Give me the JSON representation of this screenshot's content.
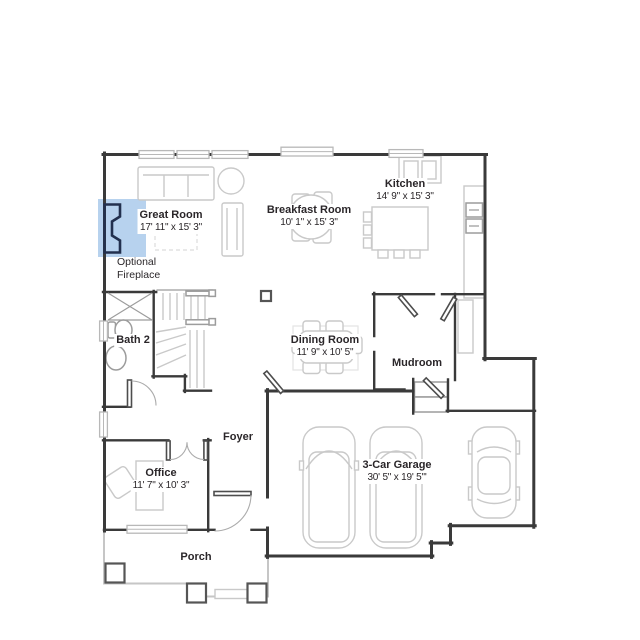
{
  "colors": {
    "wall": "#3a3a3a",
    "line_light": "#c9c9c9",
    "line_mid": "#9c9c9c",
    "text": "#2a2629",
    "fireplace_highlight": "#b7d2ee",
    "fireplace_symbol": "#22304e",
    "background": "#ffffff"
  },
  "rooms": {
    "great_room": {
      "name": "Great Room",
      "dims": "17' 11\" x 15' 3\""
    },
    "breakfast_room": {
      "name": "Breakfast Room",
      "dims": "10' 1\" x 15' 3\""
    },
    "kitchen": {
      "name": "Kitchen",
      "dims": "14' 9\" x 15' 3\""
    },
    "bath_2": {
      "name": "Bath 2"
    },
    "dining_room": {
      "name": "Dining Room",
      "dims": "11' 9\" x 10' 5\""
    },
    "mudroom": {
      "name": "Mudroom"
    },
    "foyer": {
      "name": "Foyer"
    },
    "office": {
      "name": "Office",
      "dims": "11' 7\" x 10' 3\""
    },
    "porch": {
      "name": "Porch"
    },
    "garage": {
      "name": "3-Car Garage",
      "dims": "30' 5\" x 19' 5\"'"
    }
  },
  "annotation": {
    "fireplace_line1": "Optional",
    "fireplace_line2": "Fireplace"
  }
}
